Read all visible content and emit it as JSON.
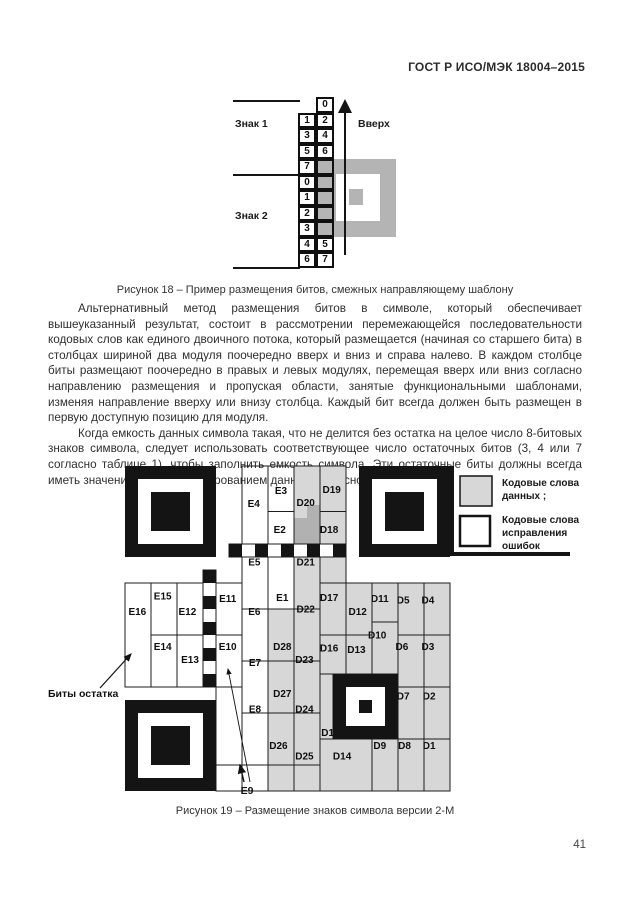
{
  "page": {
    "header": "ГОСТ Р ИСО/МЭК 18004–2015",
    "number": "41"
  },
  "paragraphs": {
    "p1": "Альтернативный метод размещения битов в символе, который обеспечивает вышеуказанный результат, состоит в рассмотрении перемежающейся последовательности кодовых слов как единого двоичного потока, который размещается (начиная со старшего бита) в столбцах шириной два модуля поочередно вверх и вниз и справа налево. В каждом столбце биты размещают поочередно в правых и левых модулях, перемещая вверх или вниз согласно направлению размещения и пропуская области, занятые функциональными шаблонами, изменяя направление вверху или внизу столбца. Каждый бит всегда должен быть размещен в первую доступную позицию для модуля.",
    "p2": "Когда емкость данных символа такая, что не делится без остатка на целое число 8-битовых знаков символа, следует использовать соответствующее число остаточных битов (3, 4 или 7 согласно таблице 1), чтобы заполнить емкость символа. Эти остаточные биты должны всегда иметь значение 0 перед маскированием данных согласно 7.8."
  },
  "figure18": {
    "caption": "Рисунок 18 – Пример размещения битов, смежных направляющему шаблону",
    "label_sign1": "Знак 1",
    "label_sign2": "Знак 2",
    "label_up": "Вверх",
    "rows": [
      [
        "",
        "0"
      ],
      [
        "1",
        "2"
      ],
      [
        "3",
        "4"
      ],
      [
        "5",
        "6"
      ],
      [
        "7",
        "#"
      ],
      [
        "0",
        "#"
      ],
      [
        "1",
        "#"
      ],
      [
        "2",
        "#"
      ],
      [
        "3",
        "#"
      ],
      [
        "4",
        "5"
      ],
      [
        "6",
        "7"
      ]
    ]
  },
  "figure19": {
    "caption": "Рисунок 19 – Размещение знаков символа версии 2-М",
    "annotation_remainder": "Биты остатка",
    "annotation_e9": "E9",
    "legend": [
      {
        "swatch": "data",
        "lines": [
          "Кодовые слова",
          "данных ;"
        ]
      },
      {
        "swatch": "ec",
        "lines": [
          "Кодовые слова",
          "исправления",
          "ошибок"
        ]
      }
    ],
    "colors": {
      "data_fill": "#d7d7d7",
      "data_dark": "#b1b1b1",
      "ink": "#1a1a1a"
    },
    "cells": [
      {
        "id": "D1",
        "c": 23,
        "r": 21,
        "w": 2,
        "h": 4,
        "lx": 23.4,
        "ly": 21.5
      },
      {
        "id": "D2",
        "c": 23,
        "r": 17,
        "w": 2,
        "h": 4,
        "lx": 23.4,
        "ly": 17.7
      },
      {
        "id": "D3",
        "c": 23,
        "r": 13,
        "w": 2,
        "h": 4,
        "lx": 23.3,
        "ly": 13.9
      },
      {
        "id": "D4",
        "c": 23,
        "r": 9,
        "w": 2,
        "h": 4,
        "lx": 23.3,
        "ly": 10.3
      },
      {
        "id": "D5",
        "c": 21,
        "r": 9,
        "w": 2,
        "h": 4,
        "lx": 21.4,
        "ly": 10.3
      },
      {
        "id": "D6",
        "c": 21,
        "r": 13,
        "w": 2,
        "h": 4,
        "lx": 21.3,
        "ly": 13.9
      },
      {
        "id": "D7",
        "c": 21,
        "r": 17,
        "w": 2,
        "h": 4,
        "lx": 21.4,
        "ly": 17.7
      },
      {
        "id": "D8",
        "c": 21,
        "r": 21,
        "w": 2,
        "h": 4,
        "lx": 21.5,
        "ly": 21.5
      },
      {
        "id": "D9",
        "c": 19,
        "r": 21,
        "w": 2,
        "h": 4,
        "lx": 19.6,
        "ly": 21.5
      },
      {
        "id": "D10",
        "c": 19,
        "r": 12,
        "w": 2,
        "h": 4,
        "lx": 19.4,
        "ly": 13.0
      },
      {
        "id": "D11",
        "c": 19,
        "r": 9,
        "w": 2,
        "h": 3,
        "lx": 19.6,
        "ly": 10.2
      },
      {
        "id": "D12",
        "c": 17,
        "r": 9,
        "w": 2,
        "h": 4,
        "lx": 17.9,
        "ly": 11.2
      },
      {
        "id": "D13",
        "c": 17,
        "r": 13,
        "w": 2,
        "h": 3,
        "lx": 17.8,
        "ly": 14.1
      },
      {
        "id": "D14",
        "c": 15,
        "r": 21,
        "w": 4,
        "h": 4,
        "lx": 16.7,
        "ly": 22.3
      },
      {
        "id": "D15",
        "c": 15,
        "r": 16,
        "w": 1,
        "h": 5,
        "lx": 15.8,
        "ly": 20.5
      },
      {
        "id": "D16",
        "c": 15,
        "r": 13,
        "w": 2,
        "h": 3,
        "lx": 15.7,
        "ly": 14.0
      },
      {
        "id": "D17",
        "c": 15,
        "r": 9,
        "w": 2,
        "h": 4,
        "lx": 15.7,
        "ly": 10.1
      },
      {
        "id": "D18",
        "c": 15,
        "r": 3.5,
        "w": 2,
        "h": 2.5,
        "lx": 15.7,
        "ly": 4.9
      },
      {
        "id": "",
        "c": 15,
        "r": 7,
        "w": 2,
        "h": 2
      },
      {
        "id": "D19",
        "c": 15,
        "r": 0,
        "w": 2,
        "h": 3.5,
        "lx": 15.9,
        "ly": 1.8
      },
      {
        "id": "D20",
        "c": 13,
        "r": 0,
        "w": 2,
        "h": 6,
        "lx": 13.9,
        "ly": 2.8
      },
      {
        "id": "D21",
        "c": 13,
        "r": 7,
        "w": 2,
        "h": 4,
        "lx": 13.9,
        "ly": 7.4
      },
      {
        "id": "D22",
        "c": 13,
        "r": 11,
        "w": 2,
        "h": 4,
        "lx": 13.9,
        "ly": 11.0
      },
      {
        "id": "D23",
        "c": 13,
        "r": 15,
        "w": 2,
        "h": 4,
        "lx": 13.8,
        "ly": 14.9
      },
      {
        "id": "D24",
        "c": 13,
        "r": 19,
        "w": 2,
        "h": 4,
        "lx": 13.8,
        "ly": 18.7
      },
      {
        "id": "D25",
        "c": 13,
        "r": 23,
        "w": 2,
        "h": 2,
        "lx": 13.8,
        "ly": 22.3
      },
      {
        "id": "",
        "c": 11,
        "r": 23,
        "w": 2,
        "h": 2
      },
      {
        "id": "D26",
        "c": 11,
        "r": 19,
        "w": 2,
        "h": 4,
        "lx": 11.8,
        "ly": 21.5
      },
      {
        "id": "D27",
        "c": 11,
        "r": 15,
        "w": 2,
        "h": 4,
        "lx": 12.1,
        "ly": 17.5
      },
      {
        "id": "D28",
        "c": 11,
        "r": 11,
        "w": 2,
        "h": 4,
        "lx": 12.1,
        "ly": 13.9
      },
      {
        "id": "E1",
        "c": 11,
        "r": 7,
        "w": 2,
        "h": 4,
        "lx": 12.1,
        "ly": 10.1
      },
      {
        "id": "E2",
        "c": 11,
        "r": 3.5,
        "w": 2,
        "h": 2.5,
        "lx": 11.9,
        "ly": 4.9
      },
      {
        "id": "E3",
        "c": 11,
        "r": 0,
        "w": 2,
        "h": 3.5,
        "lx": 12.0,
        "ly": 1.9
      },
      {
        "id": "E4",
        "c": 9,
        "r": 0,
        "w": 2,
        "h": 6,
        "lx": 9.9,
        "ly": 2.9
      },
      {
        "id": "E5",
        "c": 9,
        "r": 7,
        "w": 2,
        "h": 4,
        "lx": 9.95,
        "ly": 7.4
      },
      {
        "id": "E6",
        "c": 9,
        "r": 11,
        "w": 2,
        "h": 4,
        "lx": 9.95,
        "ly": 11.2
      },
      {
        "id": "E7",
        "c": 9,
        "r": 15,
        "w": 2,
        "h": 4,
        "lx": 10.0,
        "ly": 15.1
      },
      {
        "id": "E8",
        "c": 9,
        "r": 19,
        "w": 2,
        "h": 4,
        "lx": 10.0,
        "ly": 18.7
      },
      {
        "id": "",
        "c": 9,
        "r": 23,
        "w": 2,
        "h": 2
      },
      {
        "id": "E10",
        "c": 7,
        "r": 13,
        "w": 2,
        "h": 4,
        "lx": 7.9,
        "ly": 13.9
      },
      {
        "id": "E11",
        "c": 7,
        "r": 9,
        "w": 2,
        "h": 4,
        "lx": 7.9,
        "ly": 10.2
      },
      {
        "id": "",
        "c": 7,
        "r": 17,
        "w": 2,
        "h": 6
      },
      {
        "id": "",
        "c": 7,
        "r": 23,
        "w": 2,
        "h": 2
      },
      {
        "id": "E12",
        "c": 4,
        "r": 9,
        "w": 2,
        "h": 4,
        "lx": 4.8,
        "ly": 11.2
      },
      {
        "id": "E13",
        "c": 4,
        "r": 13,
        "w": 2,
        "h": 4,
        "lx": 5.0,
        "ly": 14.9
      },
      {
        "id": "E14",
        "c": 2,
        "r": 13,
        "w": 2,
        "h": 4,
        "lx": 2.9,
        "ly": 13.9
      },
      {
        "id": "E15",
        "c": 2,
        "r": 9,
        "w": 2,
        "h": 4,
        "lx": 2.9,
        "ly": 10.0
      },
      {
        "id": "E16",
        "c": 0,
        "r": 9,
        "w": 2,
        "h": 8,
        "lx": 0.95,
        "ly": 11.2
      }
    ]
  }
}
